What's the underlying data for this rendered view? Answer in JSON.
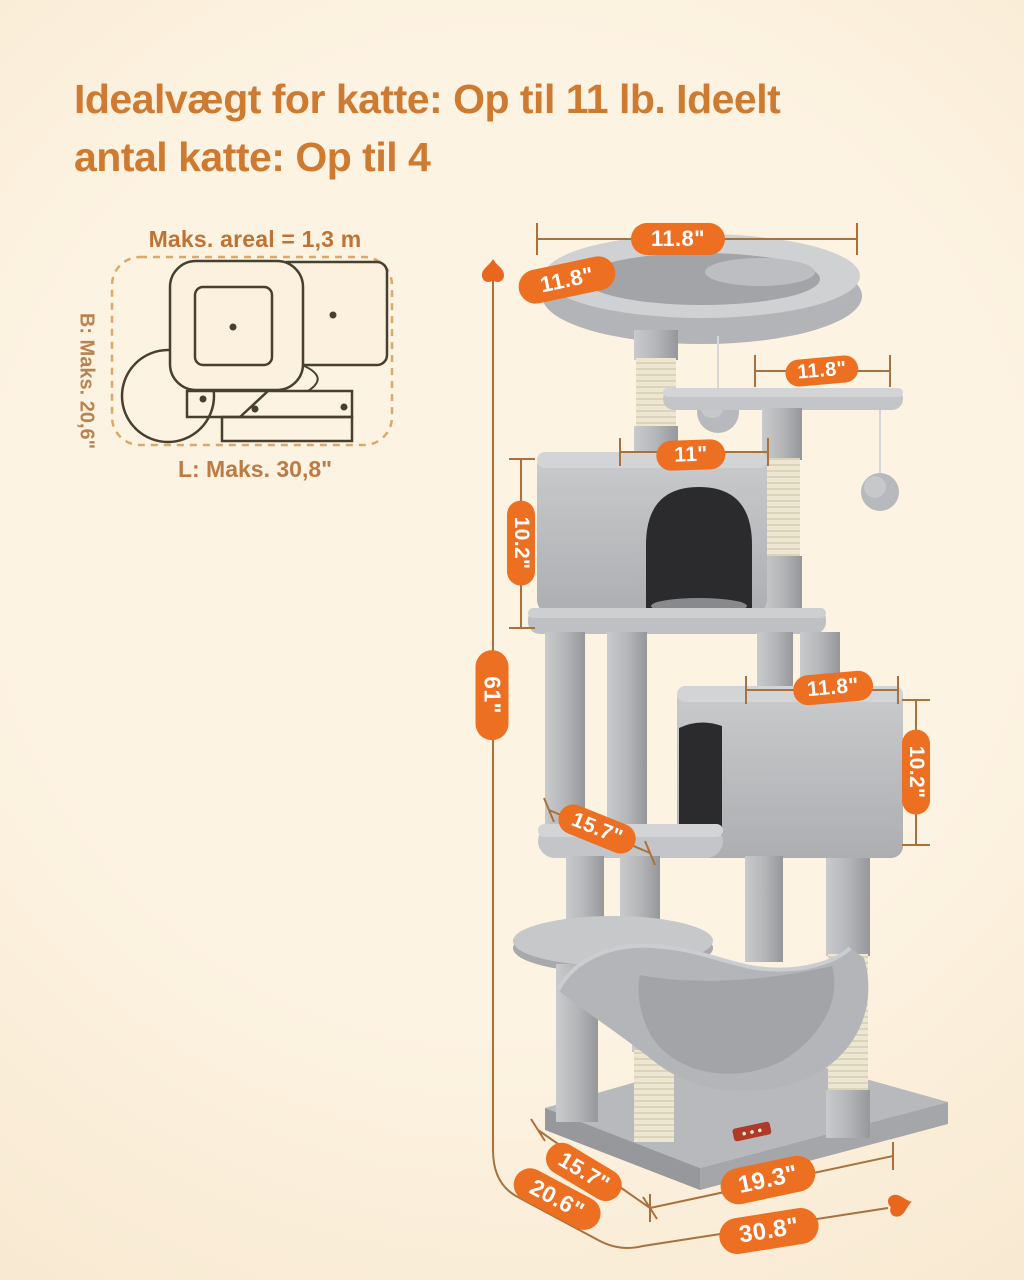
{
  "title": {
    "line1": "Idealvægt for katte: Op til 11 lb. Ideelt",
    "line2": "antal katte: Op til 4"
  },
  "footprint": {
    "area_label": "Maks. areal = 1,3 m",
    "width_label": "B: Maks. 20,6\"",
    "length_label": "L: Maks. 30,8\""
  },
  "dimensions": {
    "top_perch_width": "11.8\"",
    "top_perch_depth": "11.8\"",
    "upper_platform_width": "11.8\"",
    "upper_condo_width": "11\"",
    "upper_condo_height": "10.2\"",
    "total_height": "61\"",
    "lower_condo_width": "11.8\"",
    "lower_condo_height": "10.2\"",
    "middle_platform_depth": "15.7\"",
    "base_depth": "15.7\"",
    "base_total_depth": "20.6\"",
    "base_width": "19.3\"",
    "base_total_width": "30.8\""
  },
  "colors": {
    "background": "#FBEFDC",
    "badge_orange": "#ED6F21",
    "title_orange": "#CF7A31",
    "dimension_line": "#A8713E",
    "arrow_orange": "#E8661D",
    "footprint_outline": "#47402F",
    "footprint_dash": "#D8A96B",
    "plush_light": "#CFD1D3",
    "plush_mid": "#B5B7BA",
    "plush_dark": "#97999C",
    "sisal": "#ECE6D2",
    "condo_opening": "#2B2B2E"
  }
}
